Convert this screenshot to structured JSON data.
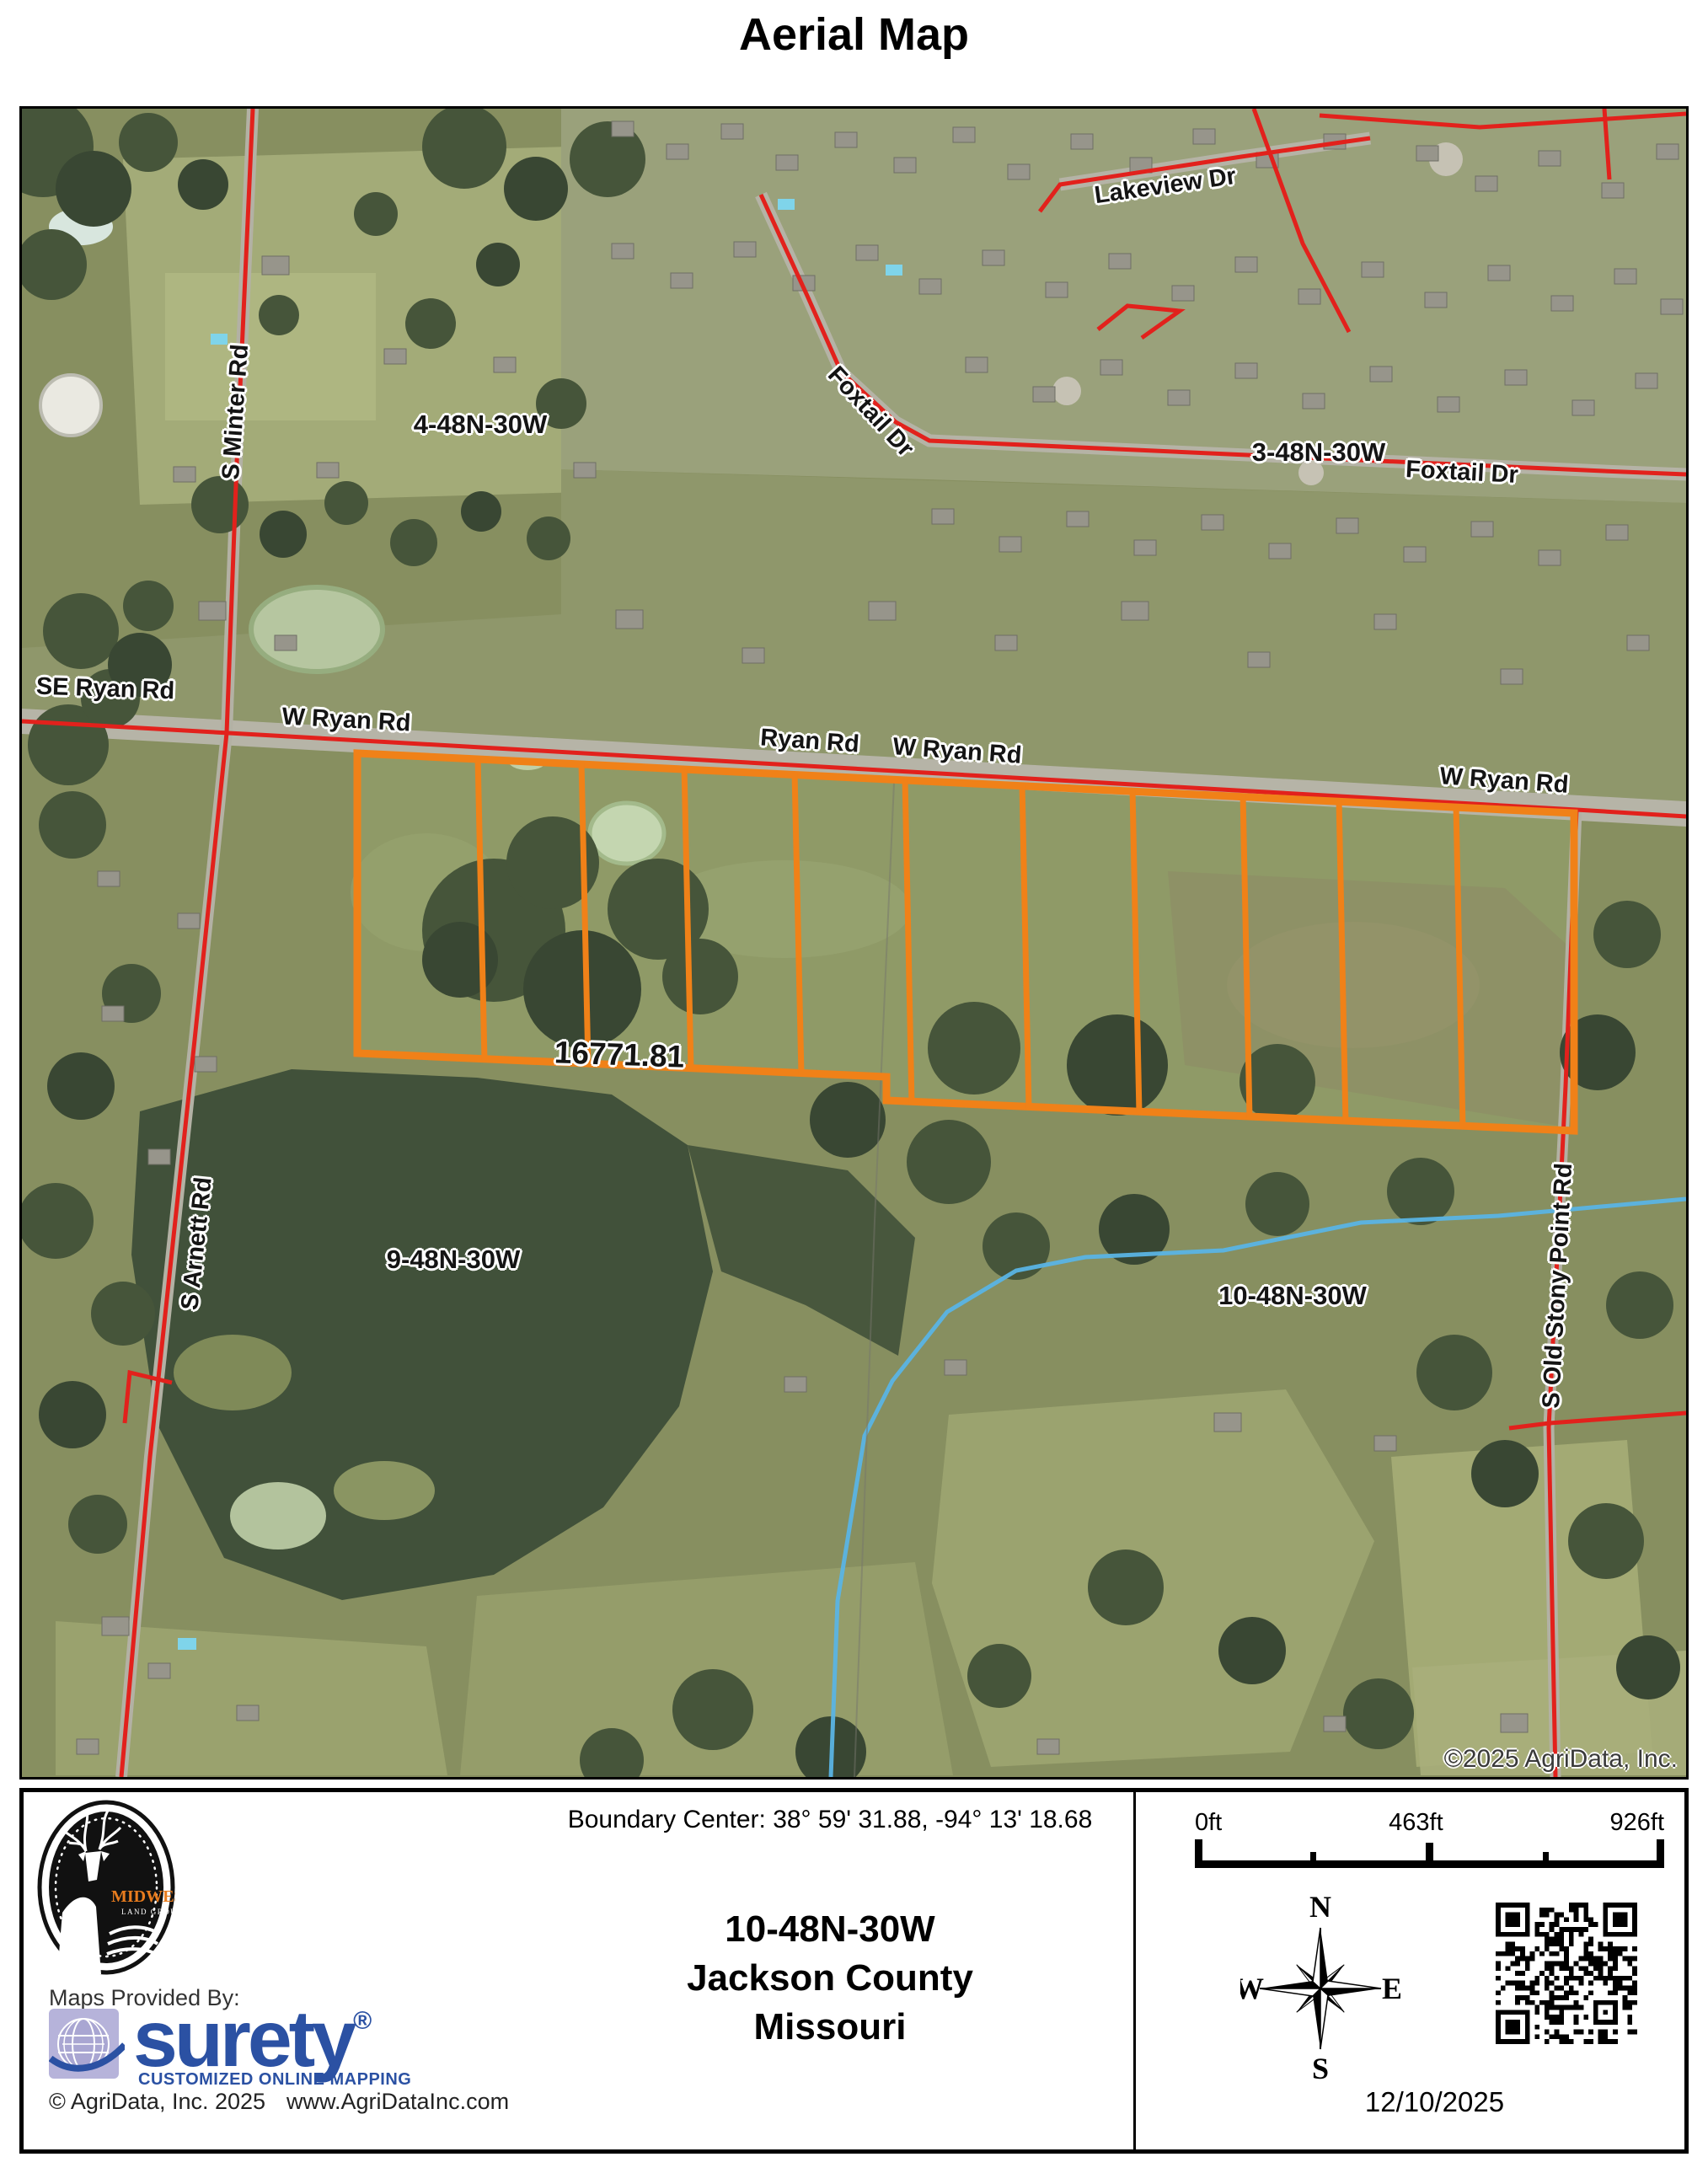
{
  "title": "Aerial Map",
  "map": {
    "labels": {
      "lakeview": "Lakeview Dr",
      "foxtail_a": "Foxtail Dr",
      "foxtail_b": "Foxtail Dr",
      "sec_4": "4-48N-30W",
      "sec_3": "3-48N-30W",
      "se_ryan": "SE Ryan Rd",
      "w_ryan_a": "W Ryan Rd",
      "ryan": "Ryan Rd",
      "w_ryan_b": "W Ryan Rd",
      "w_ryan_c": "W Ryan Rd",
      "s_minter": "S Minter Rd",
      "s_arnett": "S Arnett Rd",
      "stony_point": "S Old Stony Point Rd",
      "sec_9": "9-48N-30W",
      "sec_10": "10-48N-30W",
      "parcel_acres": "16771.81",
      "copyright": "©2025 AgriData, Inc."
    }
  },
  "footer": {
    "boundary_center": "Boundary Center: 38° 59' 31.88,  -94° 13' 18.68",
    "section": "10-48N-30W",
    "county": "Jackson County",
    "state": "Missouri",
    "scale": {
      "start": "0ft",
      "mid": "463ft",
      "end": "926ft"
    },
    "compass": {
      "n": "N",
      "e": "E",
      "s": "S",
      "w": "W"
    },
    "date": "12/10/2025",
    "provider": {
      "label": "Maps Provided By:",
      "brand": "surety",
      "registered": "®",
      "tagline": "CUSTOMIZED ONLINE MAPPING",
      "copyright": "© AgriData, Inc. 2025",
      "website": "www.AgriDataInc.com"
    },
    "logo": {
      "brand_top": "MIDWEST",
      "brand_bottom": "LAND GROUP"
    }
  },
  "colors": {
    "parcel_orange": "#f08118",
    "road_red": "#e2211c",
    "water_blue": "#5ab4e4",
    "surety_blue": "#2b51a3",
    "midwest_orange": "#e87c1e"
  }
}
